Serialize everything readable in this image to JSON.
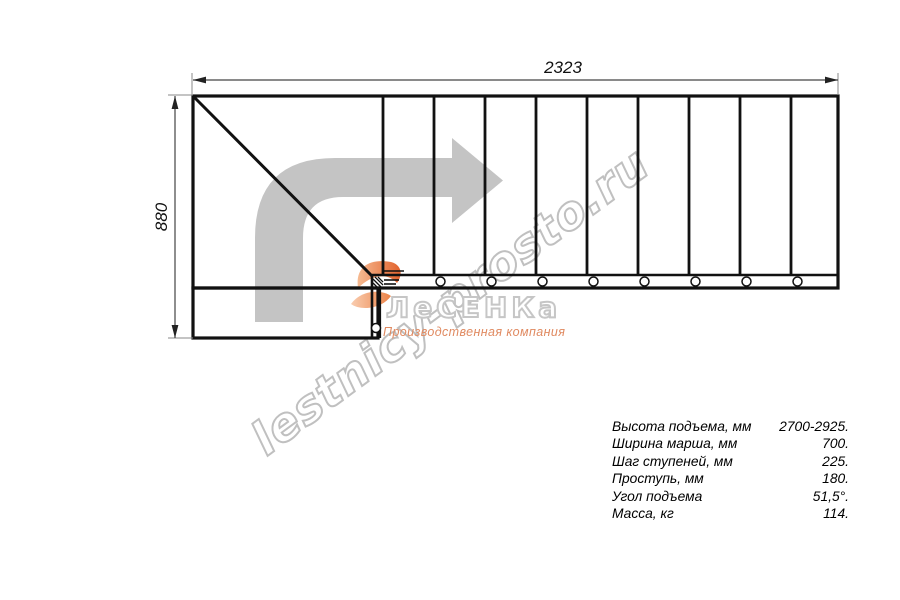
{
  "dimensions": {
    "width_label": "2323",
    "height_label": "880"
  },
  "watermark": {
    "text": "lestnicy-prosto.ru"
  },
  "logo": {
    "name": "ЛеСЕНКа",
    "tagline": "Производственная компания"
  },
  "specs": {
    "rows": [
      {
        "label": "Высота подъема, мм",
        "value": "2700-2925."
      },
      {
        "label": "Ширина марша, мм",
        "value": "700."
      },
      {
        "label": "Шаг ступеней, мм",
        "value": "225."
      },
      {
        "label": "Проступь, мм",
        "value": "180."
      },
      {
        "label": "Угол подъема",
        "value": "51,5°."
      },
      {
        "label": "Масса, кг",
        "value": "114."
      }
    ]
  },
  "colors": {
    "line_black": "#111111",
    "dim_line": "#444444",
    "extension_line": "#8a8a8a",
    "arrow_gray": "#c4c4c4",
    "watermark_gray": "#bdbdbd",
    "logo_orange": "#e2622d",
    "tagline_orange": "#e08a61"
  }
}
